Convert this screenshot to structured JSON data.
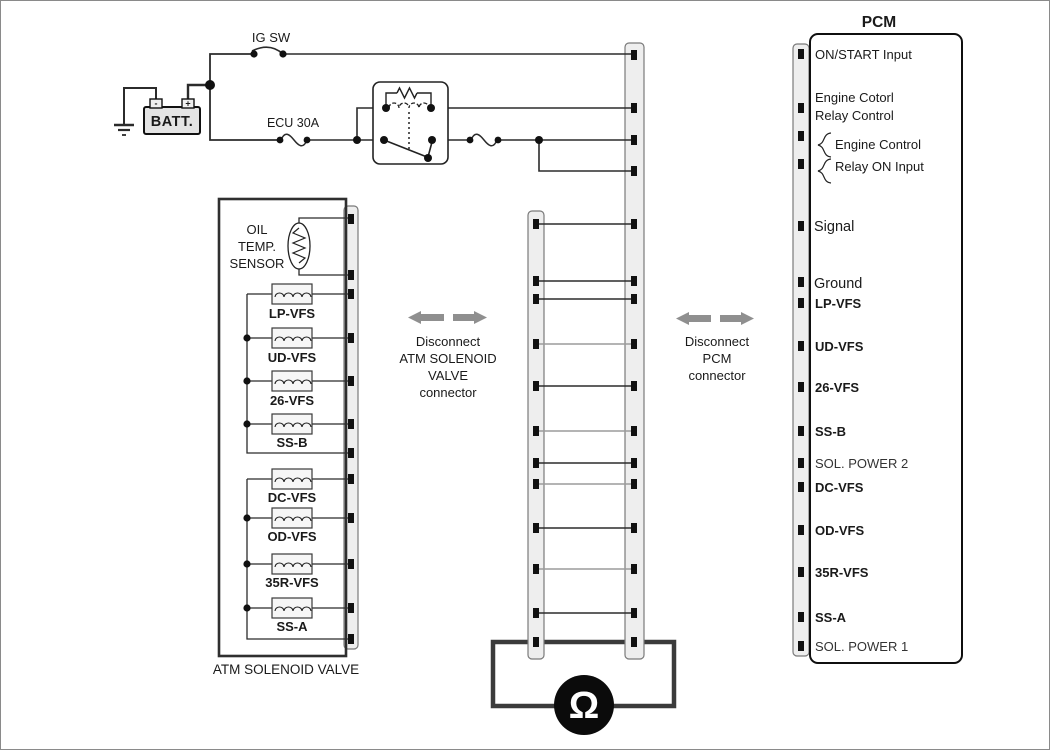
{
  "power_circuit": {
    "ig_switch_label": "IG SW",
    "battery_label": "BATT.",
    "battery_minus": "-",
    "battery_plus": "+",
    "ecu_fuse_label": "ECU 30A"
  },
  "atm_solenoid_valve": {
    "sensor_label_lines": [
      "OIL",
      "TEMP.",
      "SENSOR"
    ],
    "coil_labels": [
      "LP-VFS",
      "UD-VFS",
      "26-VFS",
      "SS-B",
      "DC-VFS",
      "OD-VFS",
      "35R-VFS",
      "SS-A"
    ],
    "caption": "ATM SOLENOID VALVE"
  },
  "annotations": {
    "disconnect_atm_lines": [
      "Disconnect",
      "ATM SOLENOID",
      "VALVE",
      "connector"
    ],
    "disconnect_pcm_lines": [
      "Disconnect",
      "PCM",
      "connector"
    ]
  },
  "pcm": {
    "title": "PCM",
    "pin_labels": [
      "ON/START Input",
      "Engine Cotorl",
      "Relay Control",
      "Engine Control",
      "Relay ON Input",
      "Signal",
      "Ground",
      "LP-VFS",
      "UD-VFS",
      "26-VFS",
      "SS-B",
      "SOL. POWER 2",
      "DC-VFS",
      "OD-VFS",
      "35R-VFS",
      "SS-A",
      "SOL. POWER 1"
    ]
  },
  "ohmmeter": {
    "symbol": "Ω"
  },
  "colors": {
    "wire": "#2b2b2b",
    "wire_gray": "#9b9b9b",
    "strip_fill": "#eeeeee",
    "strip_border": "#7a7a7a",
    "arrow_gray": "#8f8f8f",
    "valve_box_fill": "#ececec",
    "battery_fill": "#e4e4e4",
    "meter_circle": "#0b0b0b"
  }
}
